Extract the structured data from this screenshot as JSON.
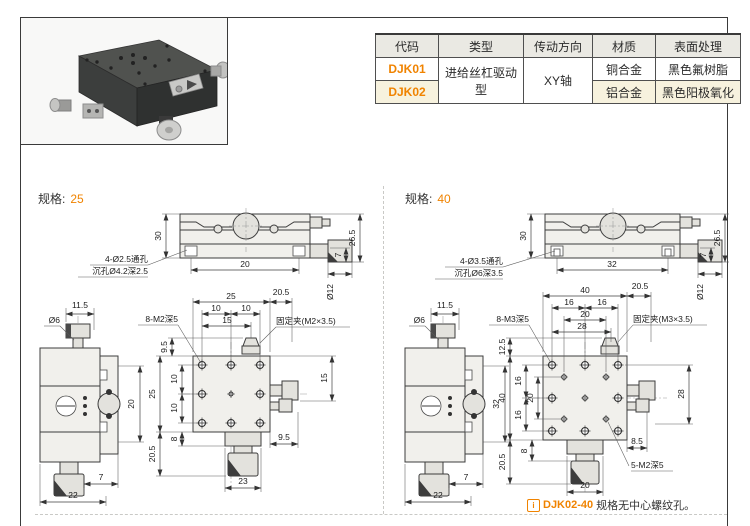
{
  "colors": {
    "accent": "#f08300",
    "table_header_bg": "#eae9e3",
    "highlight_row_bg": "#f7f2de",
    "line": "#3c3c3c"
  },
  "table": {
    "headers": [
      "代码",
      "类型",
      "传动方向",
      "材质",
      "表面处理"
    ],
    "rows": [
      {
        "code": "DJK01",
        "type": "进给丝杠驱动型",
        "direction": "XY轴",
        "material": "铜合金",
        "finish": "黑色氟树脂"
      },
      {
        "code": "DJK02",
        "material": "铝合金",
        "finish": "黑色阳极氧化"
      }
    ]
  },
  "sections": [
    {
      "name": "规格:",
      "size": "25",
      "top_view": {
        "height": "30",
        "base_width": "20",
        "total_height": "26.5",
        "knob_len": "7",
        "knob_dia": "Ø12",
        "hole_note_1": "4-Ø2.5通孔",
        "hole_note_2": "沉孔Ø4.2深2.5"
      },
      "side_view": {
        "knob_offset": "11.5",
        "shaft_dia": "Ø6",
        "travel": "20",
        "step": "7",
        "base_width": "22"
      },
      "plan_view": {
        "width": "25",
        "pitch_left": "10",
        "pitch_right": "10",
        "clamp_offset": "15",
        "right_offset": "20.5",
        "top_margin": "9.5",
        "height": "25",
        "vpitch_1": "10",
        "vpitch_2": "10",
        "bottom_ext": "20.5",
        "neck": "8",
        "side_height": "15",
        "side_margin": "9.5",
        "mount_width": "23",
        "holes_label": "8-M2深5",
        "clamp_label": "固定夹(M2×3.5)"
      }
    },
    {
      "name": "规格:",
      "size": "40",
      "top_view": {
        "height": "30",
        "base_width": "32",
        "total_height": "26.5",
        "knob_len": "7",
        "knob_dia": "Ø12",
        "hole_note_1": "4-Ø3.5通孔",
        "hole_note_2": "沉孔Ø6深3.5"
      },
      "side_view": {
        "knob_offset": "11.5",
        "shaft_dia": "Ø6",
        "travel": "32",
        "step": "7",
        "base_width": "22"
      },
      "plan_view": {
        "width": "40",
        "pitch_left": "16",
        "pitch_right": "16",
        "inner_pitch": "20",
        "clamp_offset": "28",
        "right_offset": "20.5",
        "top_margin": "12.5",
        "height": "40",
        "vpitch_1": "16",
        "vpitch_mid": "20",
        "vpitch_2": "16",
        "bottom_ext": "20.5",
        "neck": "8",
        "side_height": "28",
        "side_margin": "8.5",
        "mount_width": "20",
        "holes_label": "8-M3深5",
        "clamp_label": "固定夹(M3×3.5)",
        "center_holes_label": "5-M2深5"
      }
    }
  ],
  "note": {
    "icon": "i",
    "code": "DJK02-40",
    "text": "规格无中心螺纹孔。"
  }
}
